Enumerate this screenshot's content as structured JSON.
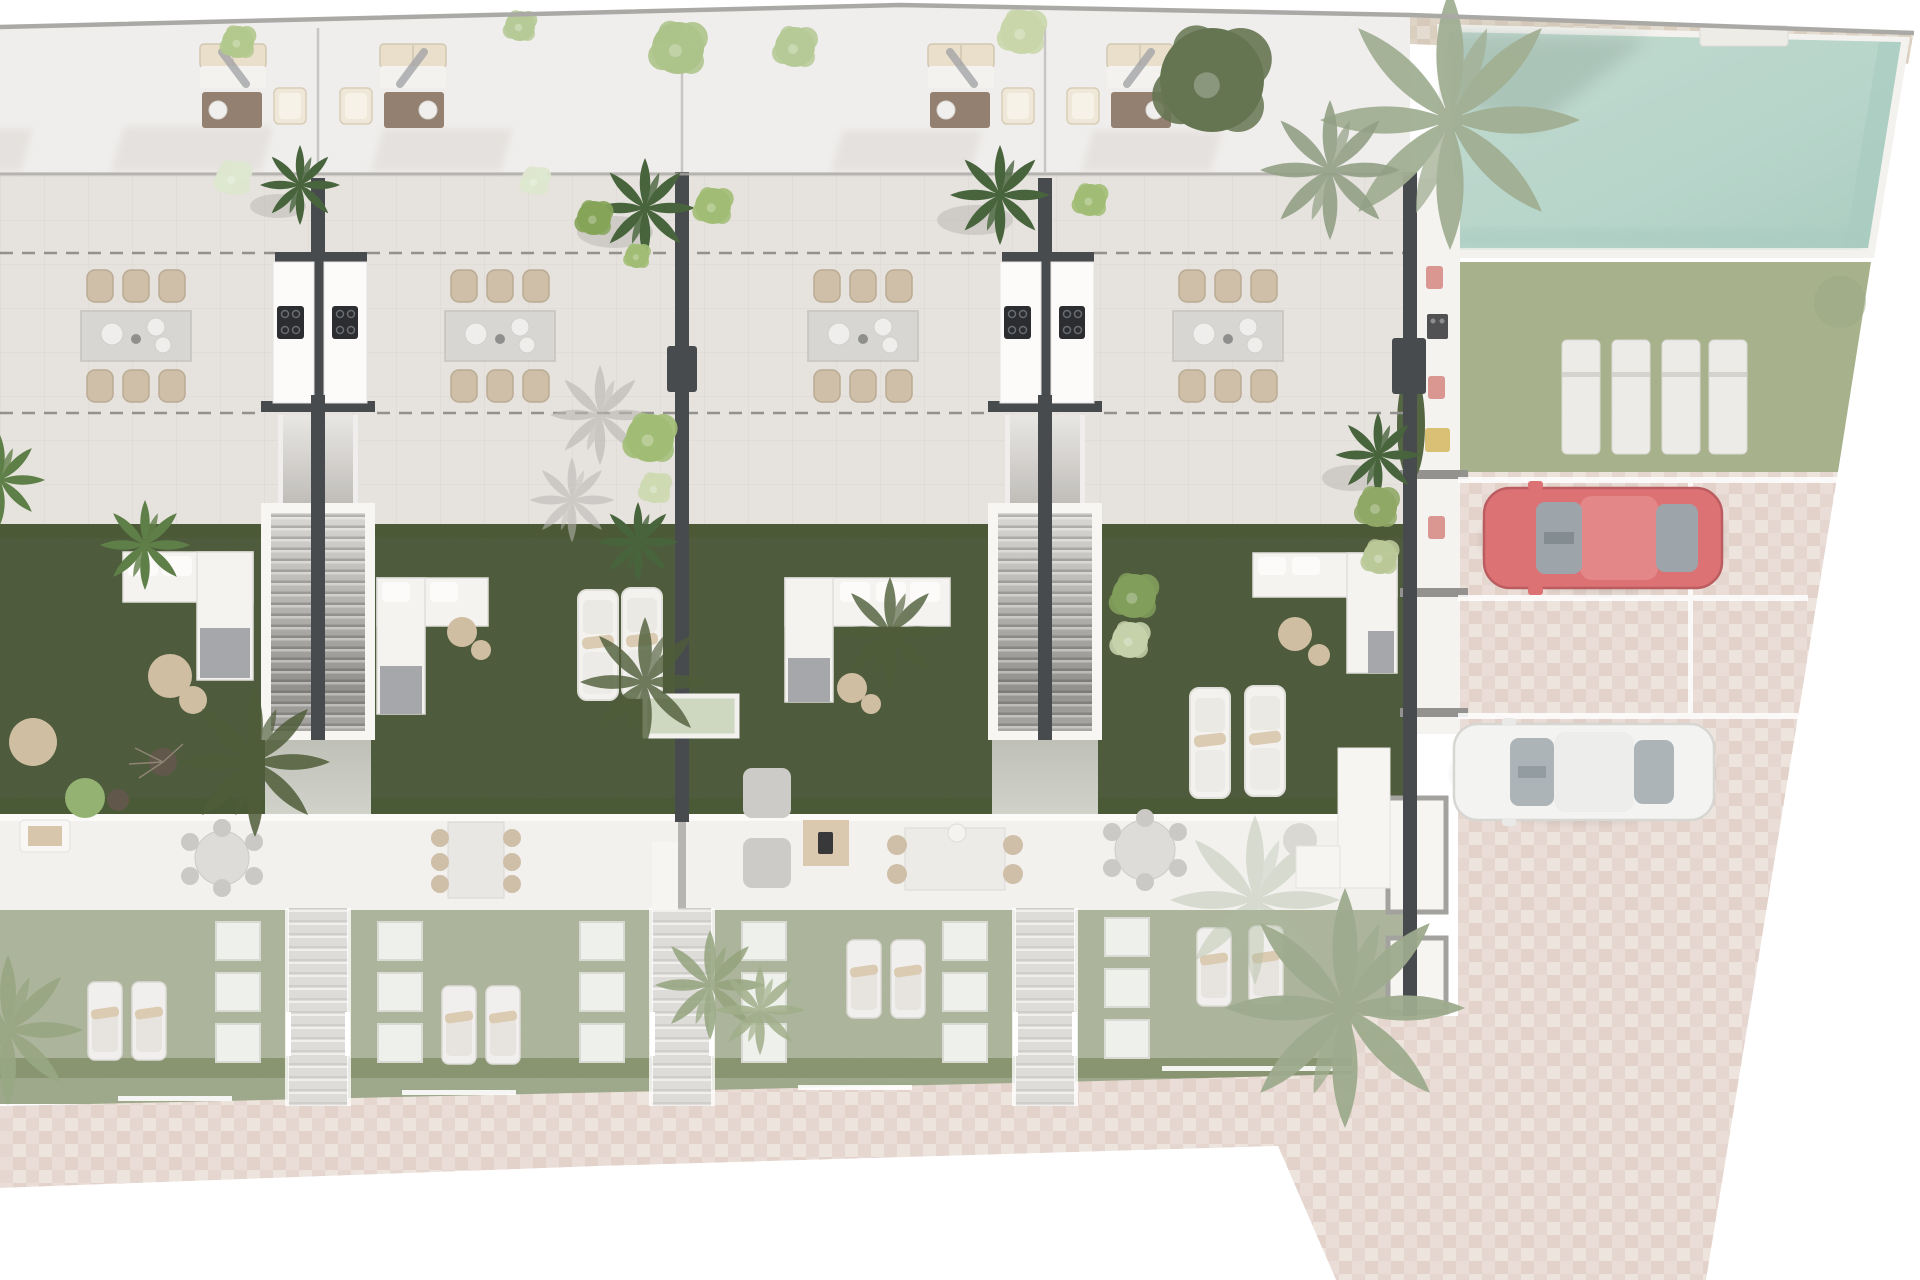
{
  "meta": {
    "type": "architectural-site-plan-render",
    "view": "top-down",
    "visible_text": "none"
  },
  "scene": {
    "townhouse_units": 4,
    "party_walls": 4,
    "per_unit_features": [
      "roof-lounge-set",
      "terrace-dining-set",
      "garden-lawn",
      "garden-sofa",
      "sun-loungers",
      "lower-garden-loungers",
      "entry-path"
    ],
    "shared_features": [
      "double-garden-staircase-x2",
      "outdoor-kitchen-with-hob-x2",
      "swimming-pool",
      "pool-lawn-with-4-loungers",
      "parking-court",
      "sidewalk"
    ],
    "vehicles": [
      {
        "name": "red-car",
        "color_name": "red",
        "orientation": "horizontal"
      },
      {
        "name": "white-car",
        "color_name": "white",
        "orientation": "horizontal"
      }
    ],
    "parking_stalls": 3,
    "pool_loungers": 4
  },
  "colors": {
    "outside": "#ffffff",
    "boundary": "#a7a5a2",
    "rooftop": "#f0eeec",
    "roofshadow": "#d9d6d2",
    "terrace": "#e5e1dc",
    "tileline": "#78706a",
    "dash": "#8e8c8a",
    "wall": "#3f4244",
    "wallfade": "#a3a19d",
    "kitchen": "#fcfbfa",
    "hob": "#202225",
    "burner": "#62666b",
    "stairlight": "#dad8d4",
    "stairdark": "#8e8c88",
    "surround": "#f7f6f3",
    "grass": "#53643d",
    "grassdark": "#41512c",
    "sofa": "#f4f3f0",
    "sofaline": "#dfddd8",
    "cushion": "#e8dec8",
    "throw": "#a2a3a7",
    "pouf": "#cdbb9d",
    "coffeetable": "#8f7a69",
    "chair": "#cdbca4",
    "chairedge": "#b7a78f",
    "tabletop": "#d6d4d0",
    "interior": "#f2f1ee",
    "fadedgarden": "#b6c0a4",
    "fadedhedge": "#77865b",
    "planter": "#eef0ea",
    "path": "#dddbd7",
    "paving": "#e9dcd5",
    "pavingtint": "#b8938a",
    "tanstrip": "#dcd2c2",
    "pooldeck": "#f3f2ef",
    "pool": "#bfe0d4",
    "pooledge": "#a5c9bd",
    "lawn": "#aeba90",
    "lounger": "#eceae6",
    "pillow": "#d9c9ae",
    "redcar": "#dc6b6e",
    "redcardark": "#b85558",
    "redcarroof": "#e28182",
    "glass": "#98a1a6",
    "whitecar": "#f3f3f1",
    "whitecaredge": "#d5d4d0",
    "grayroom": "#9f9d99",
    "stall": "#ffffff",
    "towel": "#d9918c",
    "grill": "#48484a",
    "yellowitem": "#d7bd6d",
    "palmdark": "#3f5c33",
    "palmmid": "#57793f",
    "palmsage": "#9dab8e",
    "palmsilhouette": "#46552f",
    "palmgray": "#b6b3af",
    "treelight": "#a8c184",
    "treepale": "#dde5cd",
    "hedgegreen": "#4c5e38",
    "fence": "#ffffff"
  }
}
